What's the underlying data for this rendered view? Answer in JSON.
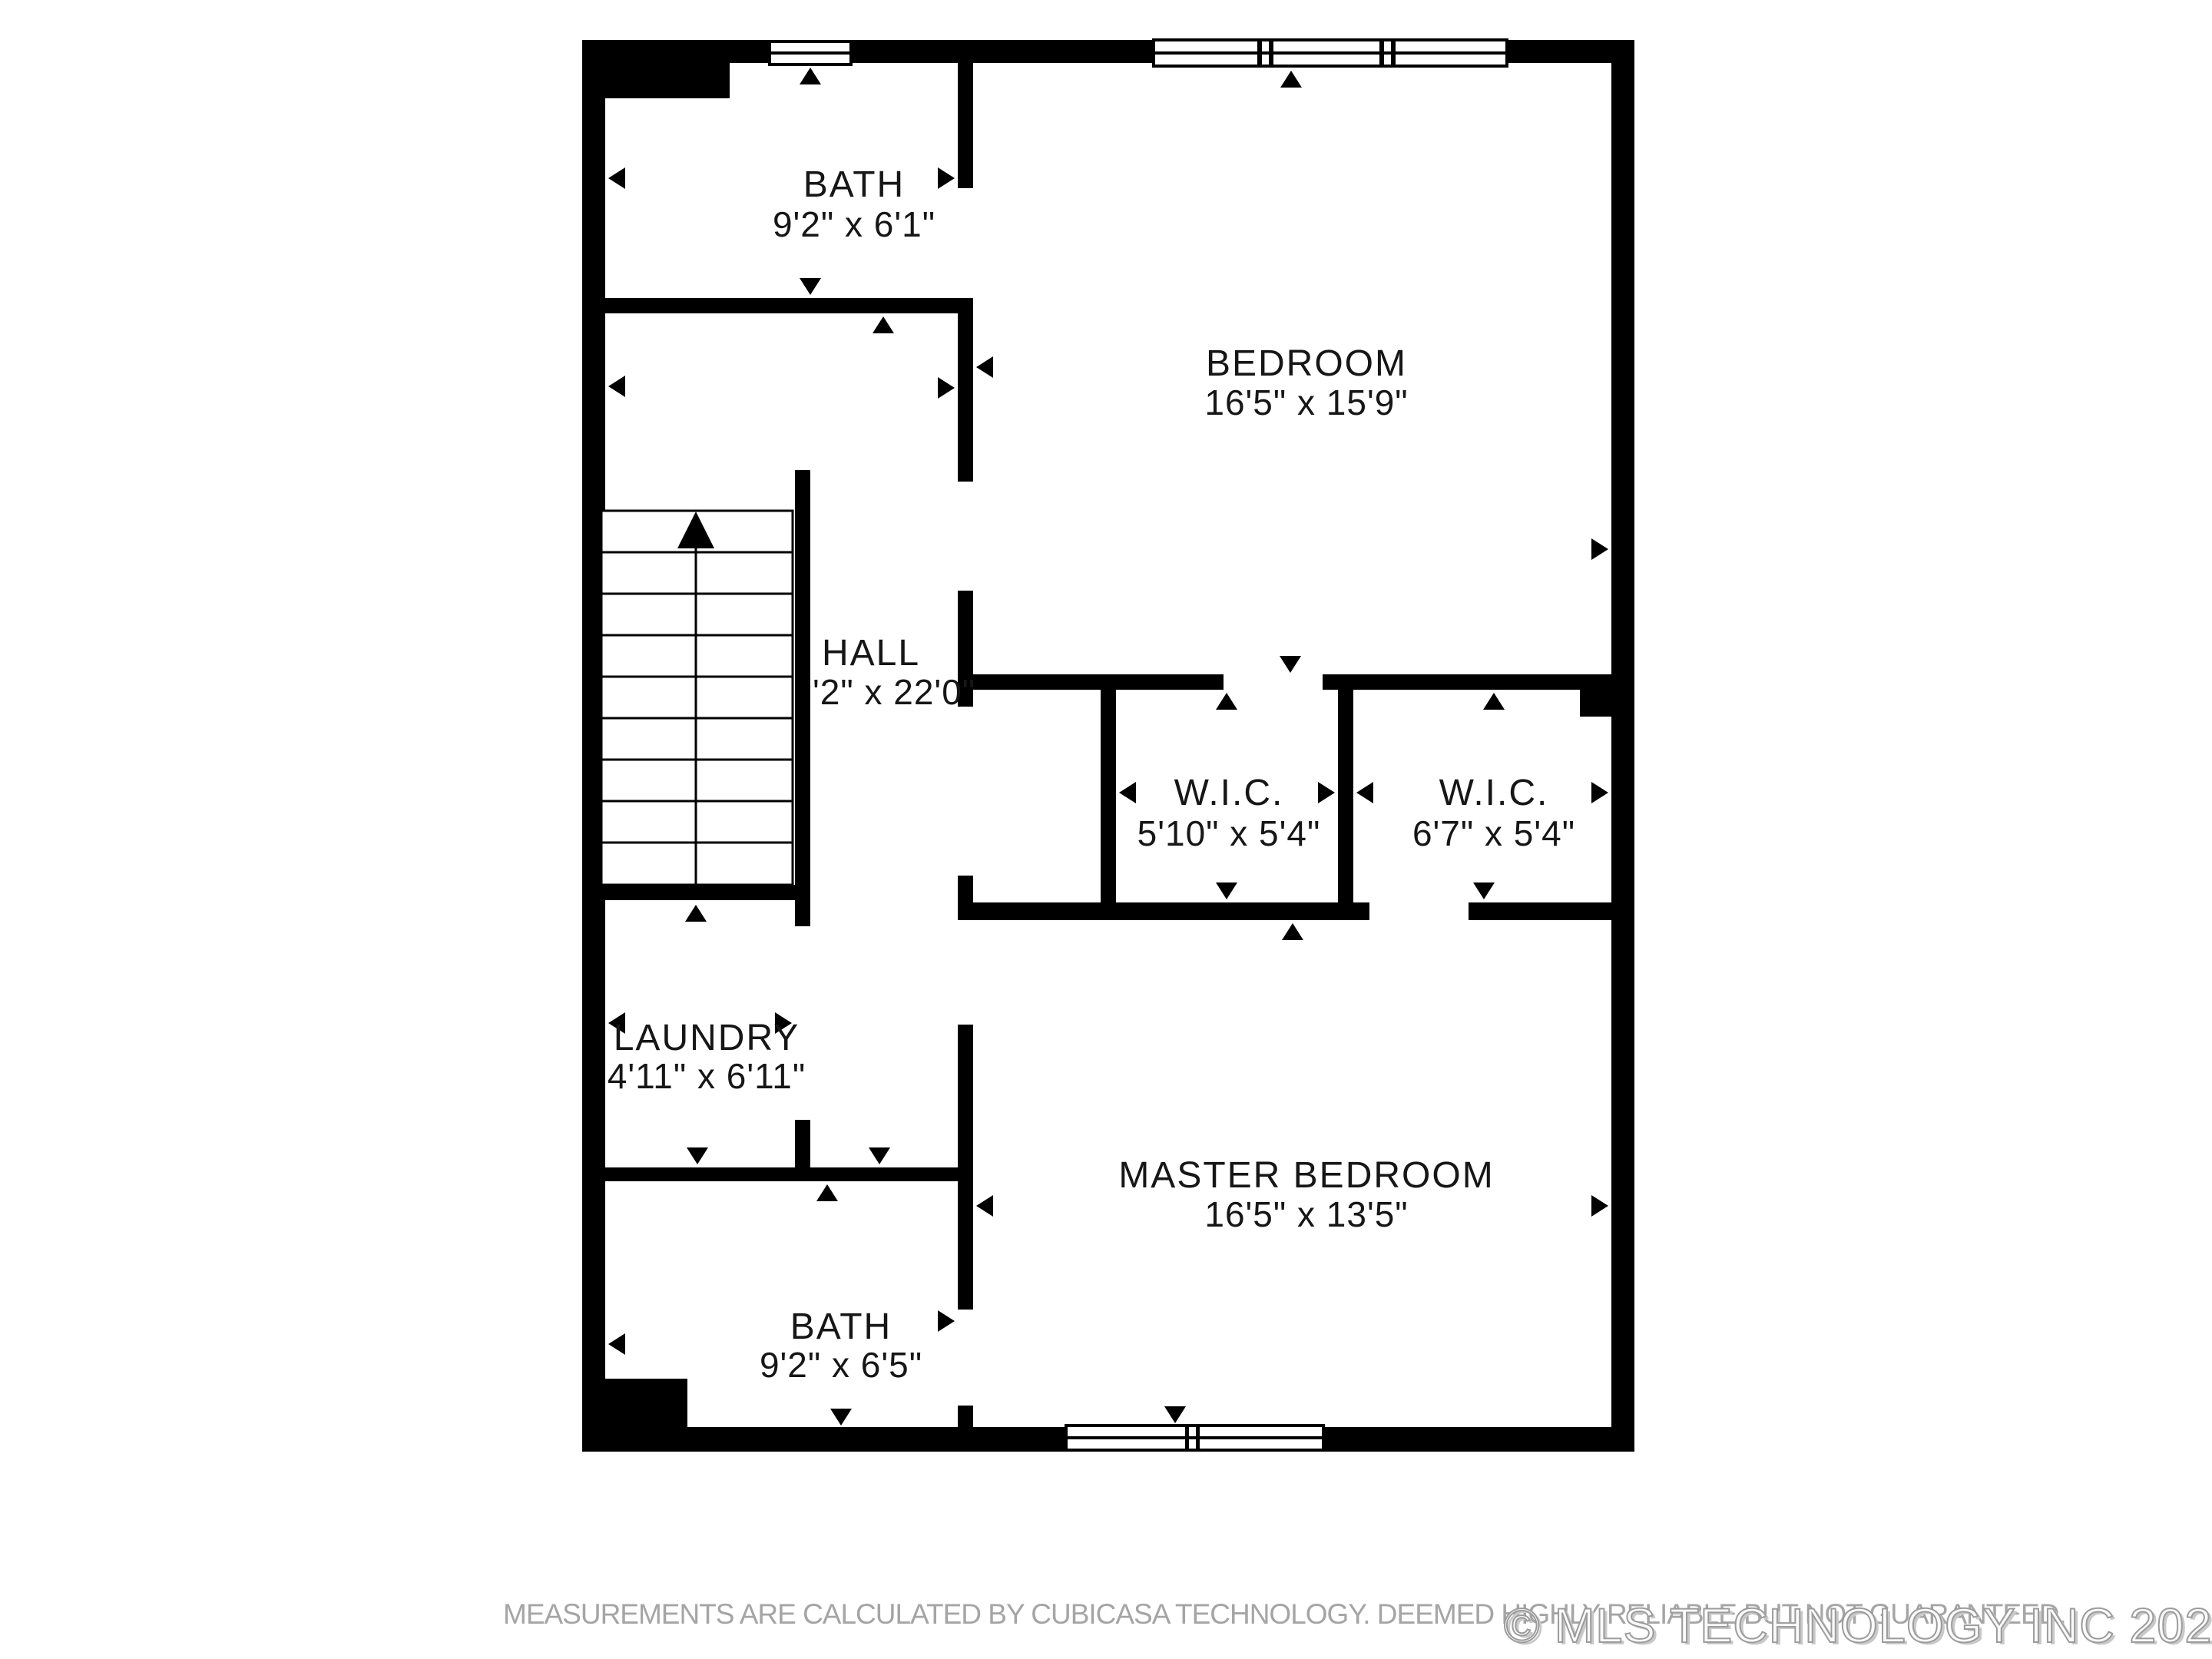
{
  "page": {
    "background": "#ffffff"
  },
  "floorplan": {
    "wall_color": "#000000",
    "label_color": "#161616",
    "rooms": [
      {
        "id": "bath-upper",
        "name": "BATH",
        "dims": "9'2\" x 6'1\""
      },
      {
        "id": "bedroom",
        "name": "BEDROOM",
        "dims": "16'5\" x 15'9\""
      },
      {
        "id": "hall",
        "name": "HALL",
        "dims": "'2\" x 22'0\""
      },
      {
        "id": "wic-left",
        "name": "W.I.C.",
        "dims": "5'10\" x 5'4\""
      },
      {
        "id": "wic-right",
        "name": "W.I.C.",
        "dims": "6'7\" x 5'4\""
      },
      {
        "id": "laundry",
        "name": "LAUNDRY",
        "dims": "4'11\" x 6'11\""
      },
      {
        "id": "master-bedroom",
        "name": "MASTER BEDROOM",
        "dims": "16'5\" x 13'5\""
      },
      {
        "id": "bath-lower",
        "name": "BATH",
        "dims": "9'2\" x 6'5\""
      }
    ]
  },
  "footer": {
    "disclaimer": "MEASUREMENTS ARE CALCULATED BY CUBICASA TECHNOLOGY. DEEMED HIGHLY RELIABLE BUT NOT GUARANTEED.",
    "disclaimer_color": "#a5a5a5",
    "watermark": "© MLS TECHNOLOGY INC 2026",
    "watermark_color": "#9c9c9c"
  }
}
